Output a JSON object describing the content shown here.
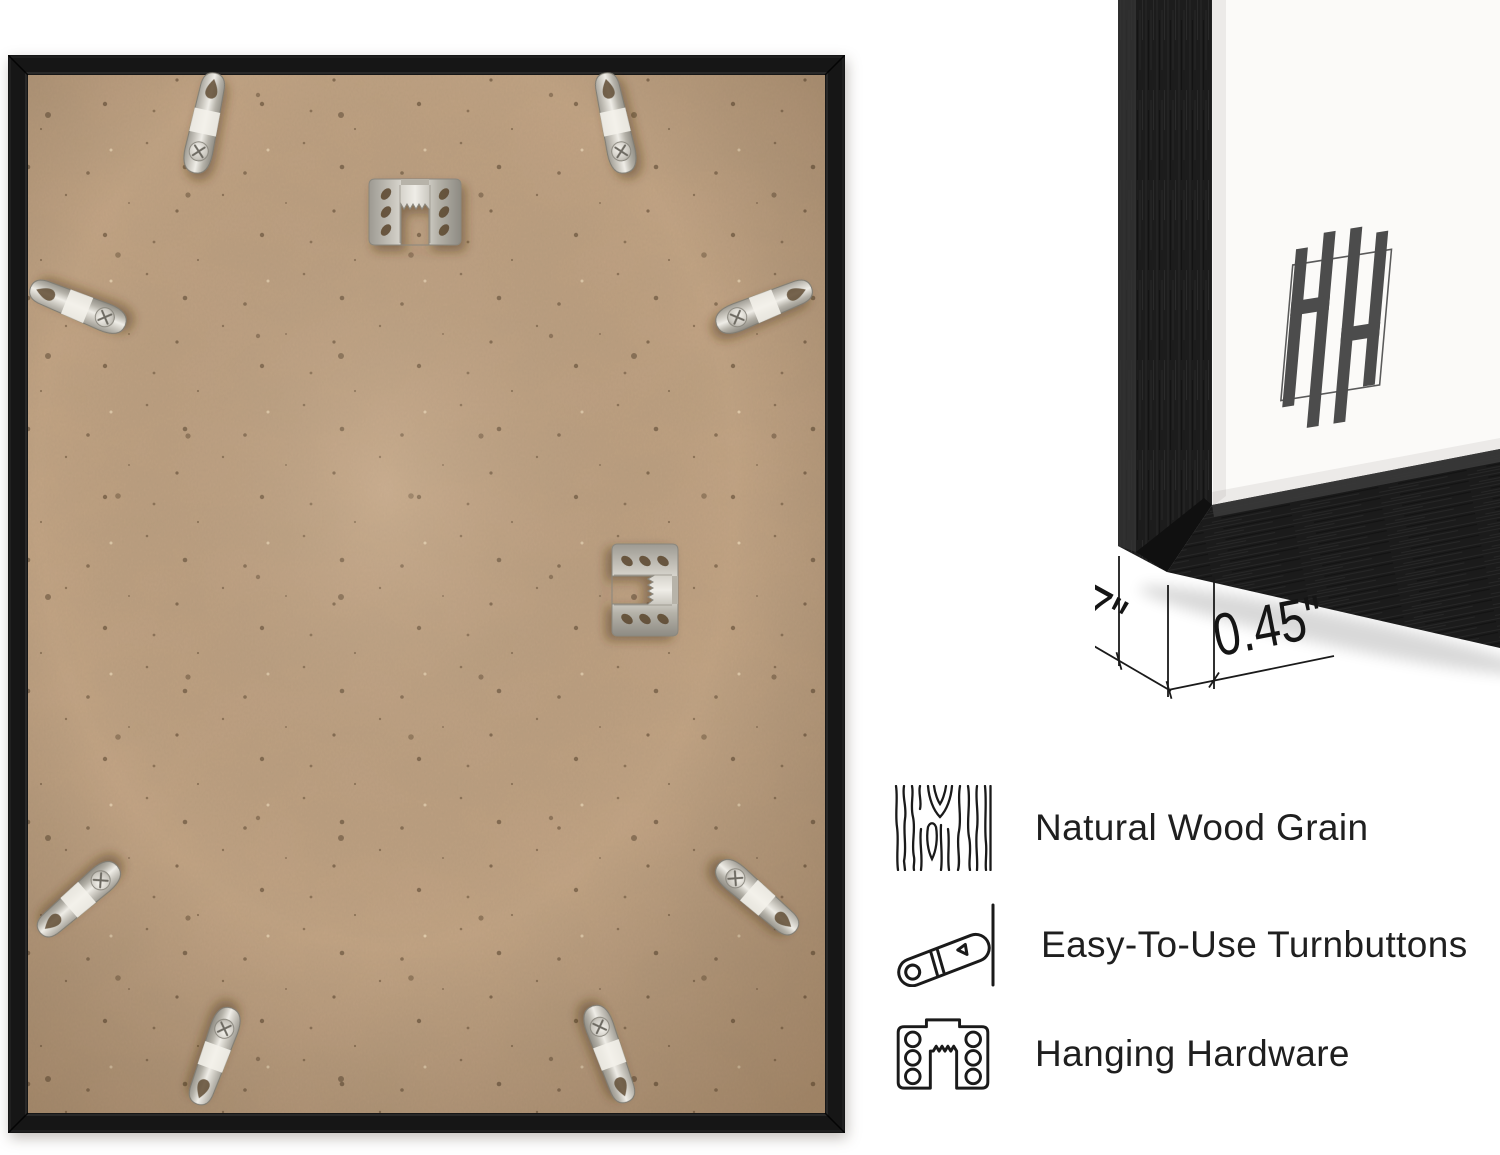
{
  "features": {
    "items": [
      {
        "icon": "wood-grain-icon",
        "label": "Natural Wood Grain"
      },
      {
        "icon": "turnbutton-icon",
        "label": "Easy-To-Use Turnbuttons"
      },
      {
        "icon": "hanging-hardware-icon",
        "label": "Hanging Hardware"
      }
    ]
  },
  "annotations": {
    "frame_depth": "0.7\"",
    "frame_face_width": "0.45\""
  },
  "photos": {
    "back_view": {
      "name": "frame-back-photo"
    },
    "corner_view": {
      "name": "frame-corner-photo",
      "logo": "HH-monogram"
    }
  },
  "colors": {
    "frame_black": "#1c1c1c",
    "backing_tan": "#c3a485",
    "hardware_silver": "#d9d6cf",
    "mat_white": "#fbfaf8",
    "text": "#1f1f1f",
    "background": "#ffffff"
  }
}
